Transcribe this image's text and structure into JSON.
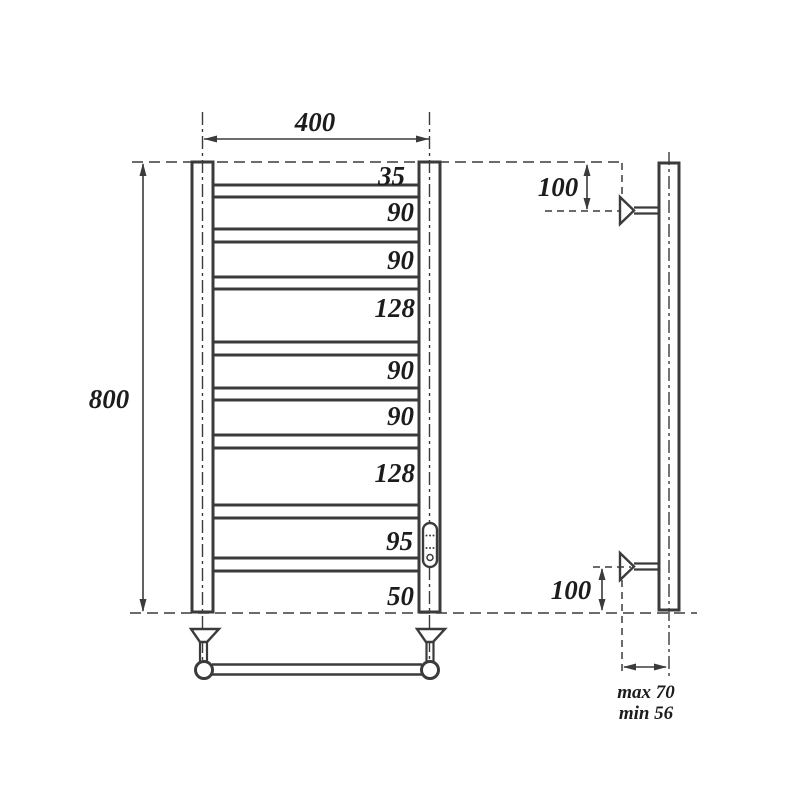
{
  "front_view": {
    "width_label": "400",
    "height_label": "800",
    "rung_gaps": [
      "35",
      "90",
      "90",
      "128",
      "90",
      "90",
      "128",
      "95",
      "50"
    ]
  },
  "side_view": {
    "top_bracket_offset_label": "100",
    "bottom_bracket_offset_label": "100",
    "wall_distance_max_label": "max 70",
    "wall_distance_min_label": "min 56"
  },
  "colors": {
    "line": "#3b3b3b",
    "dimension_text": "#1c1c1c",
    "gap_dimension_red": "#c52127",
    "background": "#ffffff"
  }
}
